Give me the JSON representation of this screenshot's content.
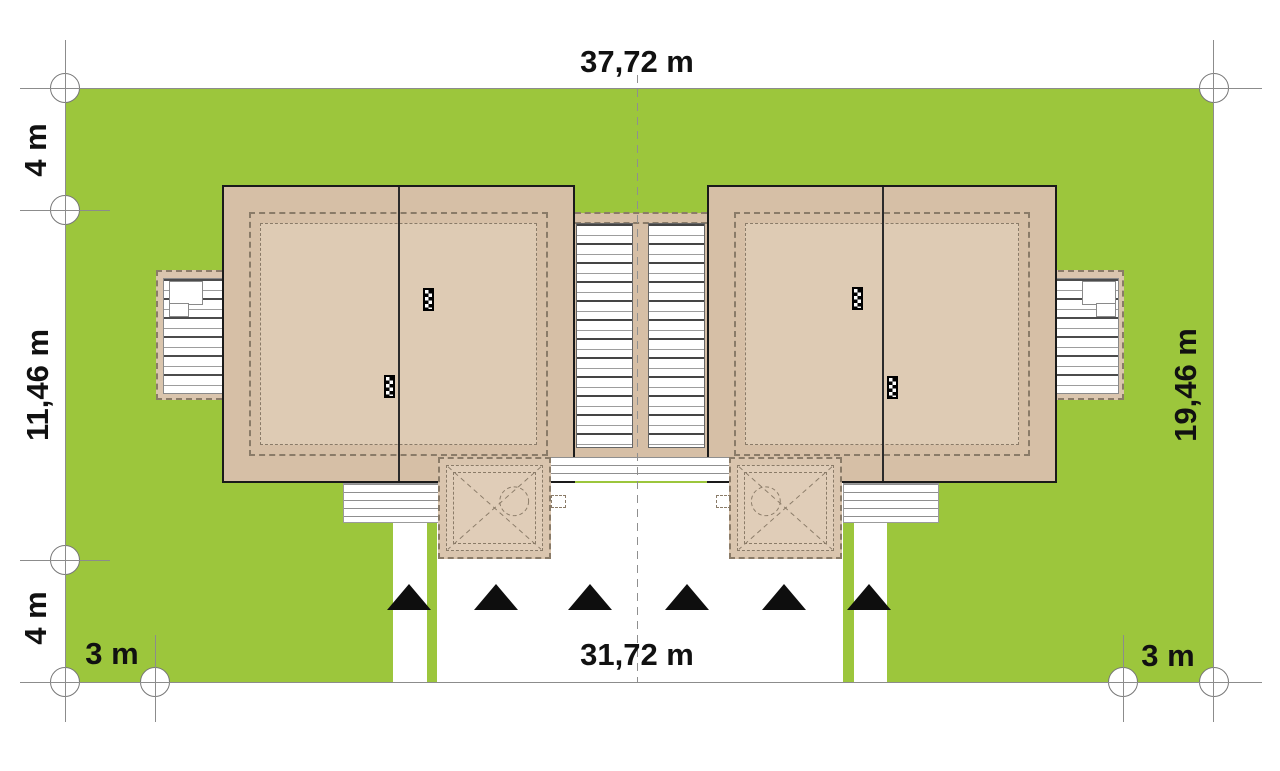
{
  "dimensions": {
    "top_width": "37,72 m",
    "left_setback_top": "4 m",
    "left_depth": "11,46 m",
    "left_setback_bottom": "4 m",
    "bottom_margin_left": "3 m",
    "bottom_width": "31,72 m",
    "bottom_margin_right": "3 m",
    "right_depth": "19,46 m"
  },
  "colors": {
    "grass": "#9CC63C",
    "roof": "#D6BFA6",
    "roof_inner": "#DECBB4",
    "canopy": "#DAC5AE",
    "canopy_inner": "#E0CDB8",
    "dash": "#8A7B68",
    "outline": "#1A1A1A"
  },
  "survey_markers": [
    {
      "x": 65,
      "y": 88
    },
    {
      "x": 1214,
      "y": 88
    },
    {
      "x": 65,
      "y": 210
    },
    {
      "x": 65,
      "y": 560
    },
    {
      "x": 65,
      "y": 682
    },
    {
      "x": 155,
      "y": 682
    },
    {
      "x": 1123,
      "y": 682
    },
    {
      "x": 1214,
      "y": 682
    }
  ],
  "access_triangles_x": [
    409,
    496,
    590,
    687,
    784,
    869
  ]
}
